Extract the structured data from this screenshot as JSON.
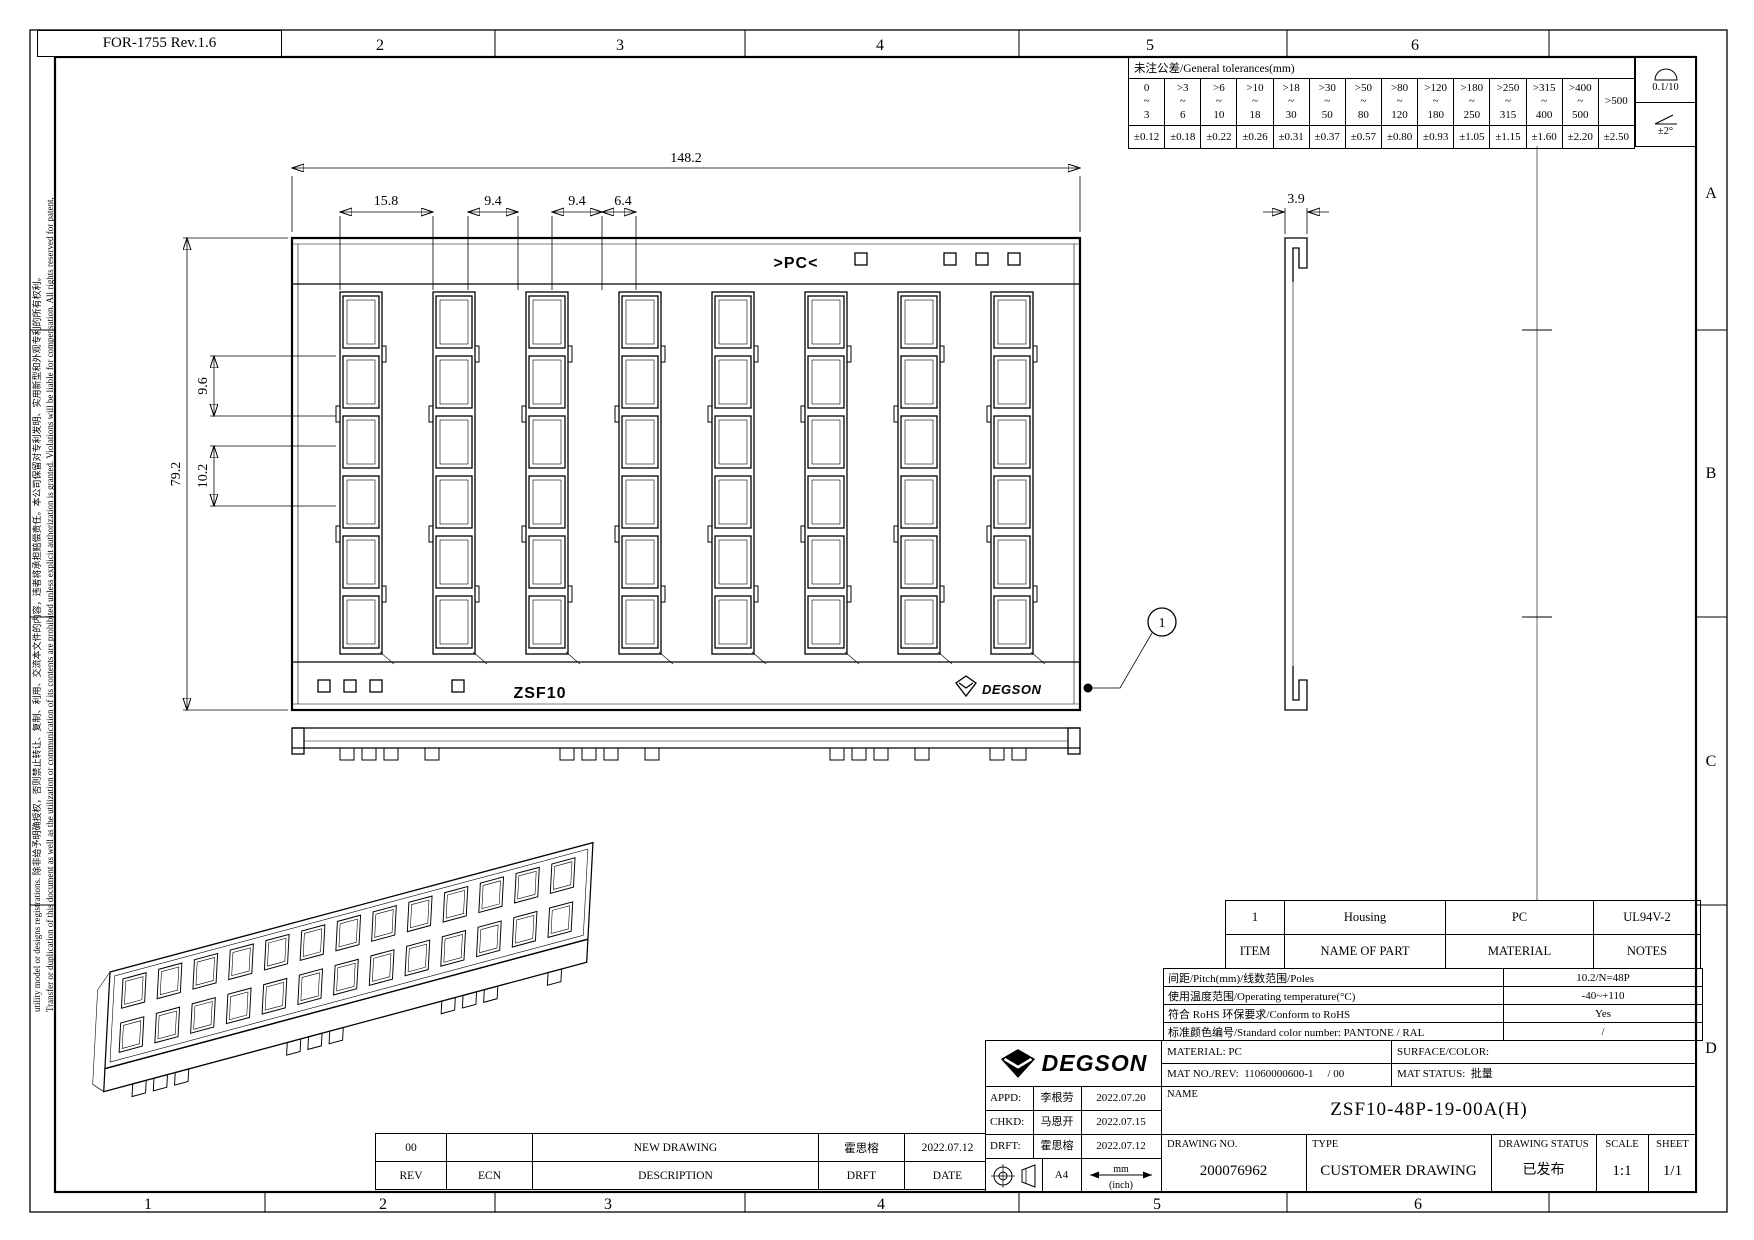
{
  "form_ref": "FOR-1755 Rev.1.6",
  "colors": {
    "line": "#000000",
    "background": "#ffffff"
  },
  "zones": {
    "top": [
      "2",
      "3",
      "4",
      "5",
      "6"
    ],
    "bottom": [
      "1",
      "2",
      "3",
      "4",
      "5",
      "6"
    ],
    "right": [
      "A",
      "B",
      "C",
      "D"
    ]
  },
  "margin_note": {
    "line_outer": "utility model or designs registrations. 除非给予明确授权，否则禁止转让、复制、利用、交流本文件的内容，违者将承担赔偿责任。本公司保留对专利发明、实用新型和外观专利的所有权利。",
    "line_inner": "Transfer or duplication of this document as well as the utilization or communication of its contents are prohibited unless explicit authorization is granted. Violations will be liable for compensation. All rights reserved for patent,"
  },
  "general_t<!-- -->olerances_note": "values read from drawing",
  "general_tolerances": {
    "title": "未注公差/General tolerances(mm)",
    "tilde": "~",
    "cols": [
      {
        "over": "0",
        "upto": "3",
        "tol": "±0.12"
      },
      {
        "over": ">3",
        "upto": "6",
        "tol": "±0.18"
      },
      {
        "over": ">6",
        "upto": "10",
        "tol": "±0.22"
      },
      {
        "over": ">10",
        "upto": "18",
        "tol": "±0.26"
      },
      {
        "over": ">18",
        "upto": "30",
        "tol": "±0.31"
      },
      {
        "over": ">30",
        "upto": "50",
        "tol": "±0.37"
      },
      {
        "over": ">50",
        "upto": "80",
        "tol": "±0.57"
      },
      {
        "over": ">80",
        "upto": "120",
        "tol": "±0.80"
      },
      {
        "over": ">120",
        "upto": "180",
        "tol": "±0.93"
      },
      {
        "over": ">180",
        "upto": "250",
        "tol": "±1.05"
      },
      {
        "over": ">250",
        "upto": "315",
        "tol": "±1.15"
      },
      {
        "over": ">315",
        "upto": "400",
        "tol": "±1.60"
      },
      {
        "over": ">400",
        "upto": "500",
        "tol": "±2.20"
      }
    ],
    "last": {
      "label": ">500",
      "tol": "±2.50"
    },
    "flatness": "0.1/10",
    "angle": "±2°"
  },
  "dimensions": {
    "overall_width": "148.2",
    "pitch_group": "15.8",
    "pitch1": "9.4",
    "pitch2": "9.4",
    "slot_width": "6.4",
    "overall_height": "79.2",
    "slot_h1": "9.6",
    "slot_h2": "10.2",
    "side_thickness": "3.9"
  },
  "part_markings": {
    "pc": ">PC<",
    "series": "ZSF10",
    "brand": "DEGSON",
    "balloon": "1"
  },
  "parts_table": {
    "rows": [
      {
        "item": "1",
        "name": "Housing",
        "material": "PC",
        "notes": "UL94V-2"
      }
    ],
    "headers": {
      "item": "ITEM",
      "name": "NAME OF PART",
      "material": "MATERIAL",
      "notes": "NOTES"
    }
  },
  "spec_table": {
    "rows": [
      {
        "label": "间距/Pitch(mm)/线数范围/Poles",
        "value": "10.2/N=48P"
      },
      {
        "label": "使用温度范围/Operating temperature(°C)",
        "value": "-40~+110"
      },
      {
        "label": "符合 RoHS 环保要求/Conform to RoHS",
        "value": "Yes"
      },
      {
        "label": "标准颜色编号/Standard color number: PANTONE / RAL",
        "value": "/"
      }
    ]
  },
  "title_block": {
    "brand": "DEGSON",
    "approvals": [
      {
        "label": "APPD:",
        "name": "李根劳",
        "date": "2022.07.20"
      },
      {
        "label": "CHKD:",
        "name": "马恩开",
        "date": "2022.07.15"
      },
      {
        "label": "DRFT:",
        "name": "霍思榕",
        "date": "2022.07.12"
      }
    ],
    "paper_size": "A4",
    "units_mm": "mm",
    "units_inch": "(inch)",
    "material_label": "MATERIAL:",
    "material": "PC",
    "mat_no_label": "MAT NO./REV:",
    "mat_no": "11060000600-1",
    "mat_rev": "/ 00",
    "surface_label": "SURFACE/COLOR:",
    "mat_status_label": "MAT STATUS:",
    "mat_status": "批量",
    "name_label": "NAME",
    "part_name": "ZSF10-48P-19-00A(H)",
    "drawing_no_label": "DRAWING NO.",
    "drawing_no": "200076962",
    "type_label": "TYPE",
    "type_value": "CUSTOMER DRAWING",
    "status_label": "DRAWING STATUS",
    "status_value": "已发布",
    "scale_label": "SCALE",
    "scale_value": "1:1",
    "sheet_label": "SHEET",
    "sheet_value": "1/1"
  },
  "revision_table": {
    "entries": [
      {
        "rev": "00",
        "ecn": "",
        "description": "NEW DRAWING",
        "drft": "霍思榕",
        "date": "2022.07.12"
      }
    ],
    "headers": {
      "rev": "REV",
      "ecn": "ECN",
      "description": "DESCRIPTION",
      "drft": "DRFT",
      "date": "DATE"
    }
  }
}
